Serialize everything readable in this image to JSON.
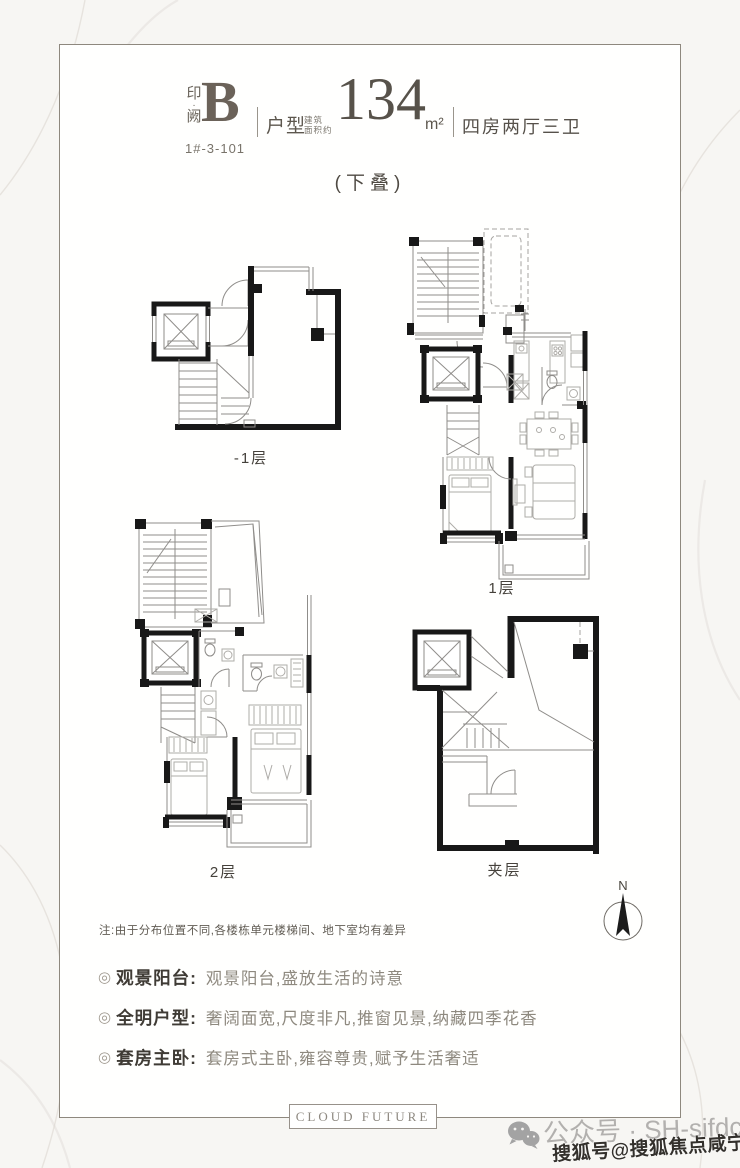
{
  "header": {
    "brand_top": "印",
    "brand_dot": "·",
    "brand_bottom": "阙",
    "unit": "B",
    "unit_code": "1#-3-101",
    "type_label": "户型",
    "area_prefix_line1": "建筑",
    "area_prefix_line2": "面积约",
    "area_value": "134",
    "area_unit": "m²",
    "rooms": "四房两厅三卫",
    "subtitle": "(下叠)"
  },
  "plans": {
    "basement": {
      "label": "-1层"
    },
    "first": {
      "label": "1层"
    },
    "second": {
      "label": "2层"
    },
    "mezzanine": {
      "label": "夹层"
    }
  },
  "compass": {
    "label": "N"
  },
  "note": "注:由于分布位置不同,各楼栋单元楼梯间、地下室均有差异",
  "features": [
    {
      "bullet": "◎",
      "label": "观景阳台:",
      "text": "观景阳台,盛放生活的诗意"
    },
    {
      "bullet": "◎",
      "label": "全明户型:",
      "text": "奢阔面宽,尺度非凡,推窗见景,纳藏四季花香"
    },
    {
      "bullet": "◎",
      "label": "套房主卧:",
      "text": "套房式主卧,雍容尊贵,赋予生活奢适"
    }
  ],
  "footer": {
    "brand": "CLOUD FUTURE",
    "wechat_label": "公众号 · SH-sifdc",
    "watermark": "搜狐号@搜狐焦点咸宁站"
  },
  "colors": {
    "frame_border": "#8e887e",
    "wall": "#181818",
    "title_text": "#57524a",
    "feature_label": "#3f3b35",
    "feature_text": "#8e897f",
    "watermark_text": "#33302c"
  }
}
